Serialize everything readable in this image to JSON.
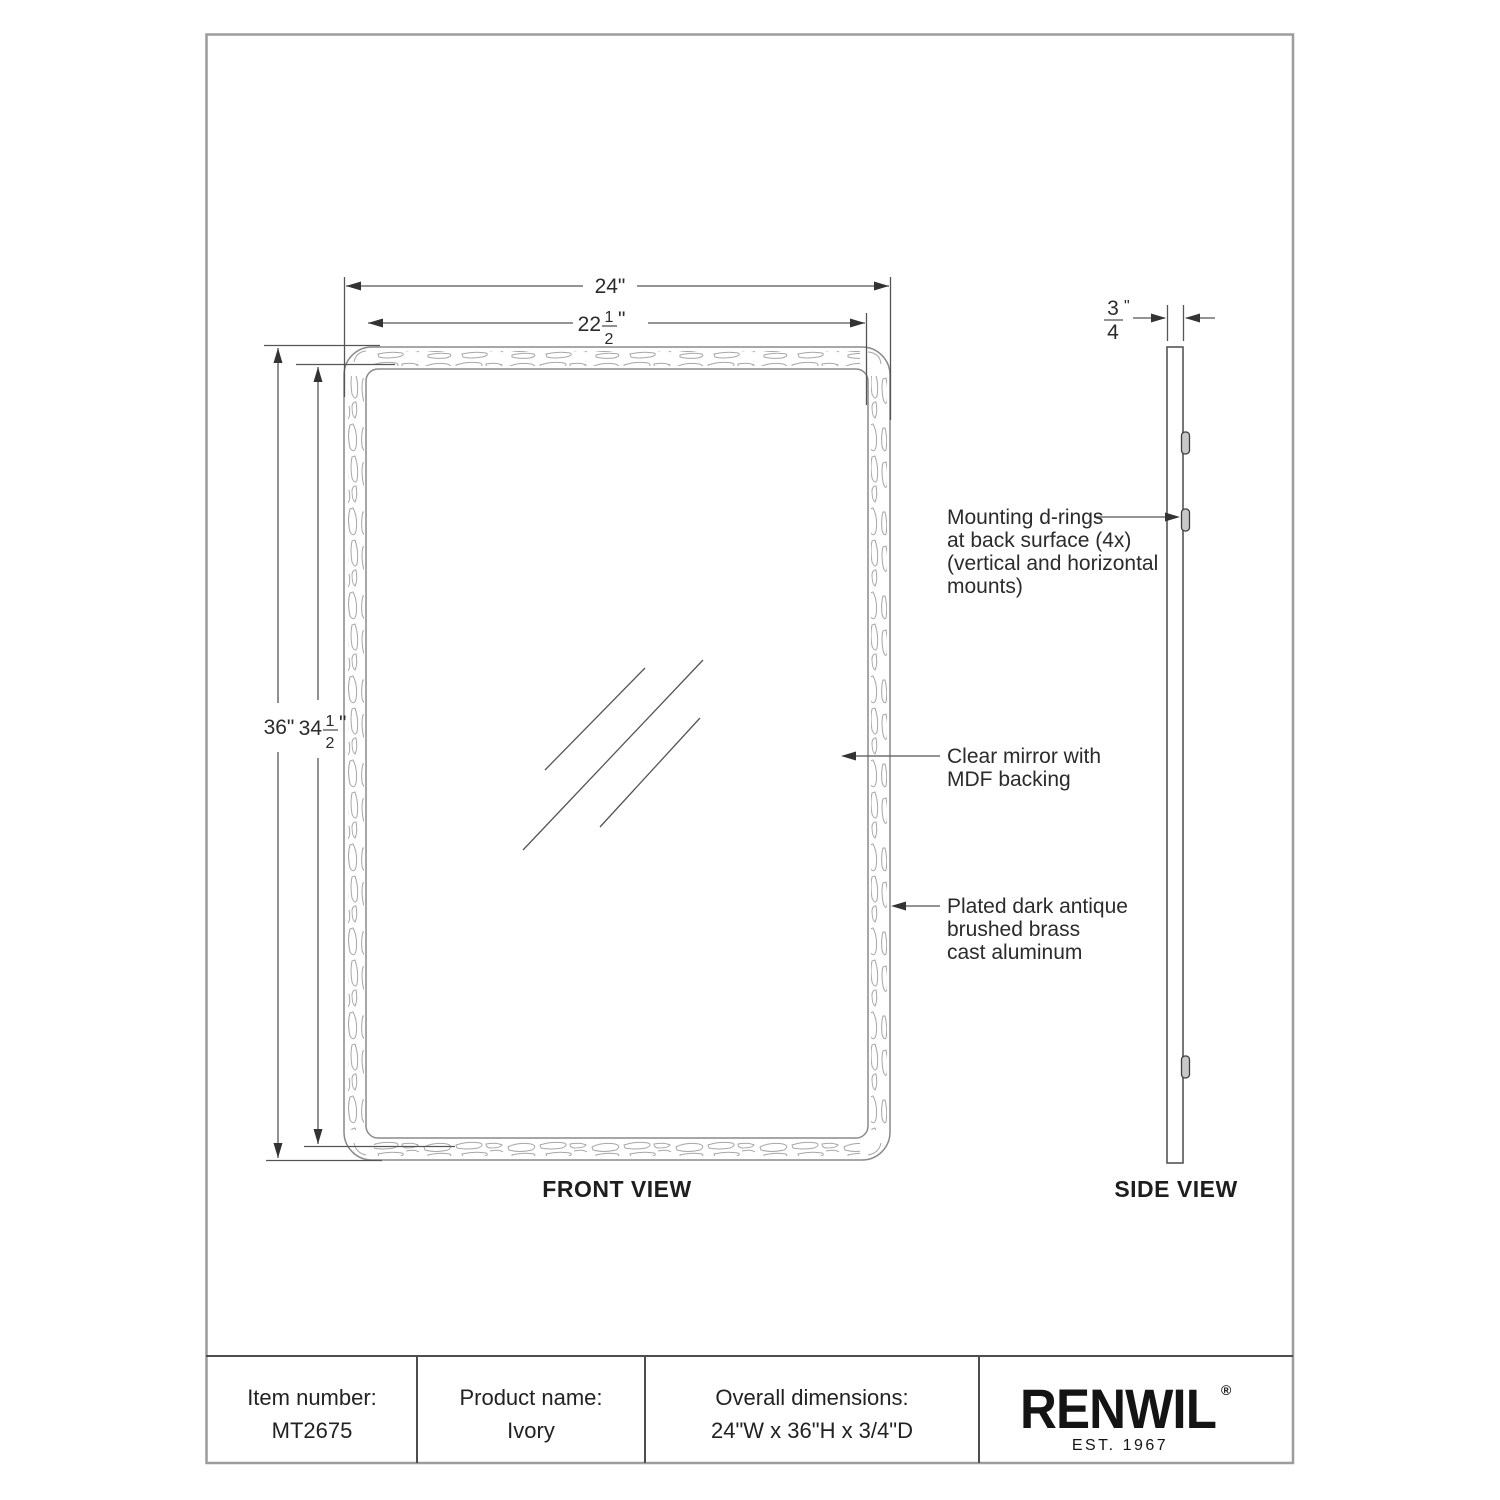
{
  "document": {
    "front_view_label": "FRONT VIEW",
    "side_view_label": "SIDE VIEW"
  },
  "dimensions": {
    "front_width_outer": "24\"",
    "front_width_inner_whole": "22",
    "front_width_inner_num": "1",
    "front_width_inner_den": "2",
    "front_width_inner_unit": "\"",
    "front_height_outer": "36\"",
    "front_height_inner_whole": "34",
    "front_height_inner_num": "1",
    "front_height_inner_den": "2",
    "front_height_inner_unit": "\"",
    "side_depth_num": "3",
    "side_depth_den": "4",
    "side_depth_unit": "\""
  },
  "annotations": {
    "mounting_line1": "Mounting d-rings",
    "mounting_line2": "at back surface (4x)",
    "mounting_line3": "(vertical and horizontal",
    "mounting_line4": "mounts)",
    "mirror_line1": "Clear mirror with",
    "mirror_line2": "MDF backing",
    "frame_line1": "Plated dark antique",
    "frame_line2": "brushed brass",
    "frame_line3": "cast aluminum"
  },
  "table": {
    "item_label": "Item number:",
    "item_value": "MT2675",
    "product_label": "Product name:",
    "product_value": "Ivory",
    "overall_label": "Overall dimensions:",
    "overall_value": "24\"W x 36\"H x 3/4\"D",
    "brand_name": "RENWIL",
    "brand_reg": "®",
    "brand_est": "EST. 1967"
  }
}
